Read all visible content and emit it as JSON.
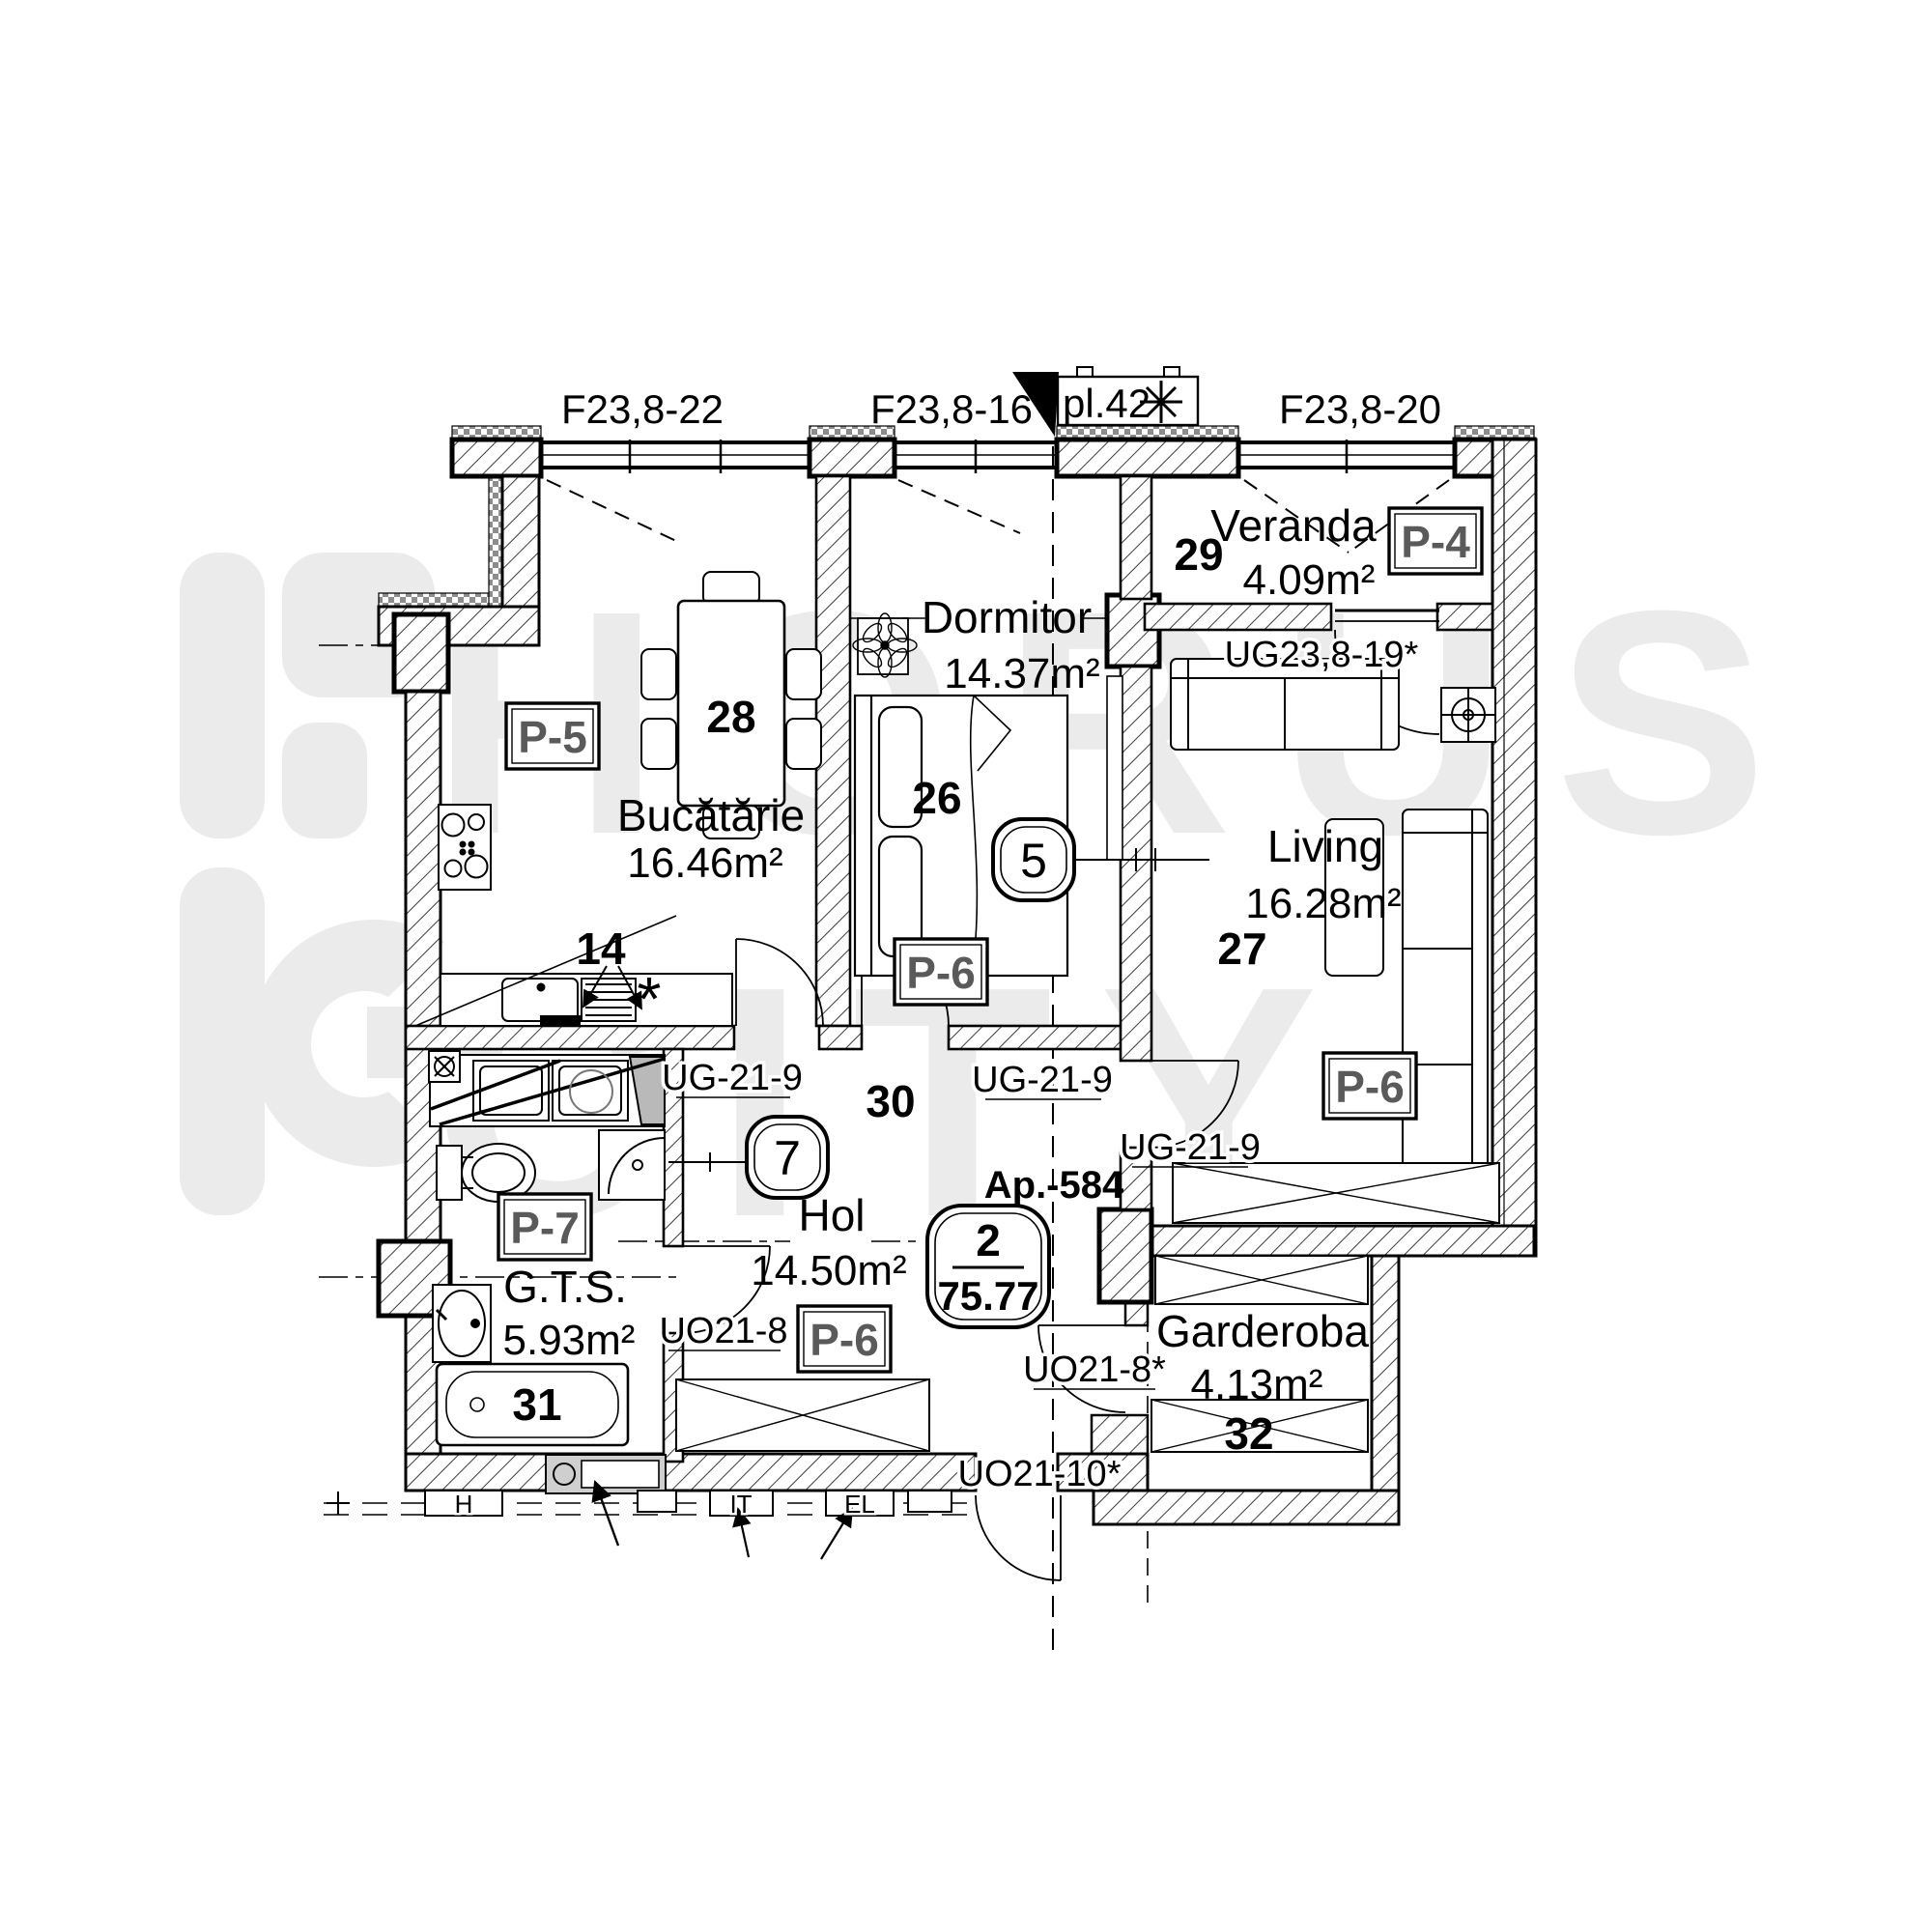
{
  "watermark": {
    "brand_top": "HORUS",
    "brand_bottom": "CITY"
  },
  "apartment": {
    "id_label": "Ap.-584",
    "room_count": "2",
    "total_area": "75.77"
  },
  "facade": {
    "window_left": "F23,8-22",
    "window_mid": "F23,8-16",
    "ac_label": "pl.42",
    "window_right": "F23,8-20"
  },
  "rooms": {
    "kitchen": {
      "name": "Bucătărie",
      "area": "16.46m²",
      "furniture_no": "28",
      "finish_code": "P-5",
      "counter_no": "14",
      "boiler_symbol": "*"
    },
    "bedroom": {
      "name": "Dormitor",
      "area": "14.37m²",
      "furniture_no": "26",
      "finish_code": "P-6"
    },
    "veranda": {
      "name": "Veranda",
      "area": "4.09m²",
      "furniture_no": "29",
      "finish_code": "P-4"
    },
    "living": {
      "name": "Living",
      "area": "16.28m²",
      "furniture_no": "27",
      "finish_code": "P-6"
    },
    "hall": {
      "name": "Hol",
      "area": "14.50m²",
      "furniture_no": "30",
      "finish_code": "P-6"
    },
    "bathroom": {
      "name": "G.T.S.",
      "area": "5.93m²",
      "furniture_no": "31",
      "finish_code": "P-7"
    },
    "wardrobe": {
      "name": "Garderoba",
      "area": "4.13m²",
      "furniture_no": "32"
    }
  },
  "axes": {
    "living": "5",
    "hall": "7"
  },
  "doors": {
    "veranda_living": "UG23,8-19*",
    "kitchen": "UG-21-9",
    "bedroom": "UG-21-9",
    "living": "UG-21-9",
    "bathroom": "UO21-8",
    "wardrobe": "UO21-8*",
    "entrance": "UO21-10*"
  },
  "niches": {
    "h": "H",
    "it": "IT",
    "el": "EL"
  }
}
